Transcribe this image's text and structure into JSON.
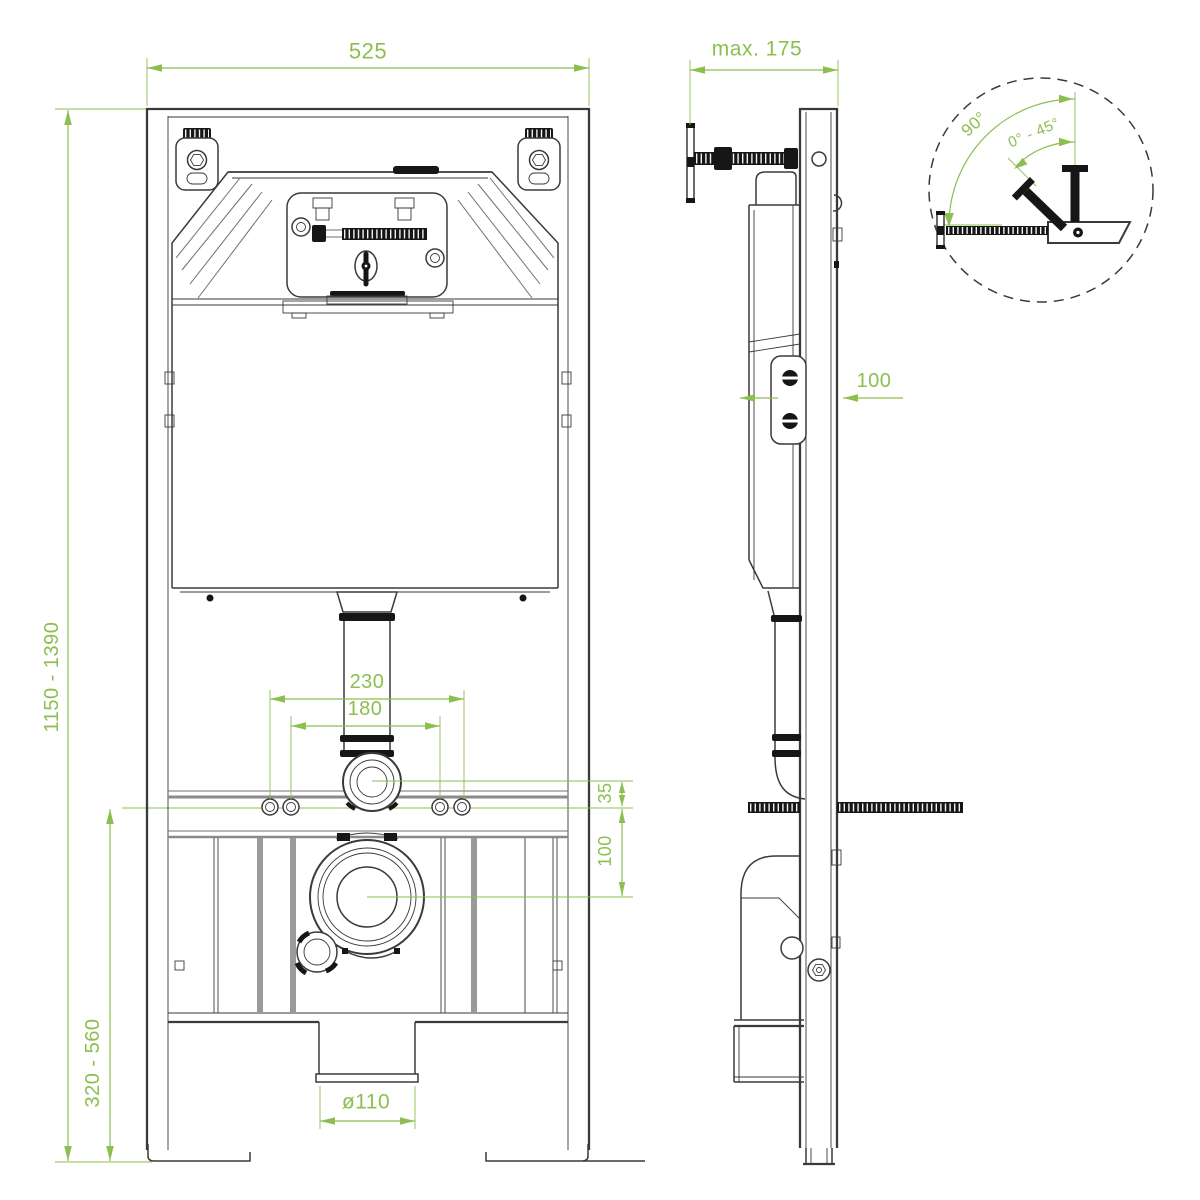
{
  "drawing": {
    "colors": {
      "dimension_green": "#8CBE50",
      "line_dark": "#3A3A3A",
      "line_gray": "#6F6F6F",
      "fill_black": "#161616",
      "background": "#FFFFFF"
    },
    "dimensions": {
      "frame_width": "525",
      "frame_depth_max": "max. 175",
      "installation_height_range": "1150 - 1390",
      "outlet_height_range": "320 - 560",
      "fixing_centres_outer": "230",
      "fixing_centres_inner": "180",
      "flush_pipe_offset": "35",
      "outlet_centre_offset": "100",
      "wall_bracket_offset": "100",
      "drain_pipe_diameter": "ø110",
      "actuation_angle_max": "90°",
      "actuation_angle_range": "0° - 45°"
    }
  }
}
